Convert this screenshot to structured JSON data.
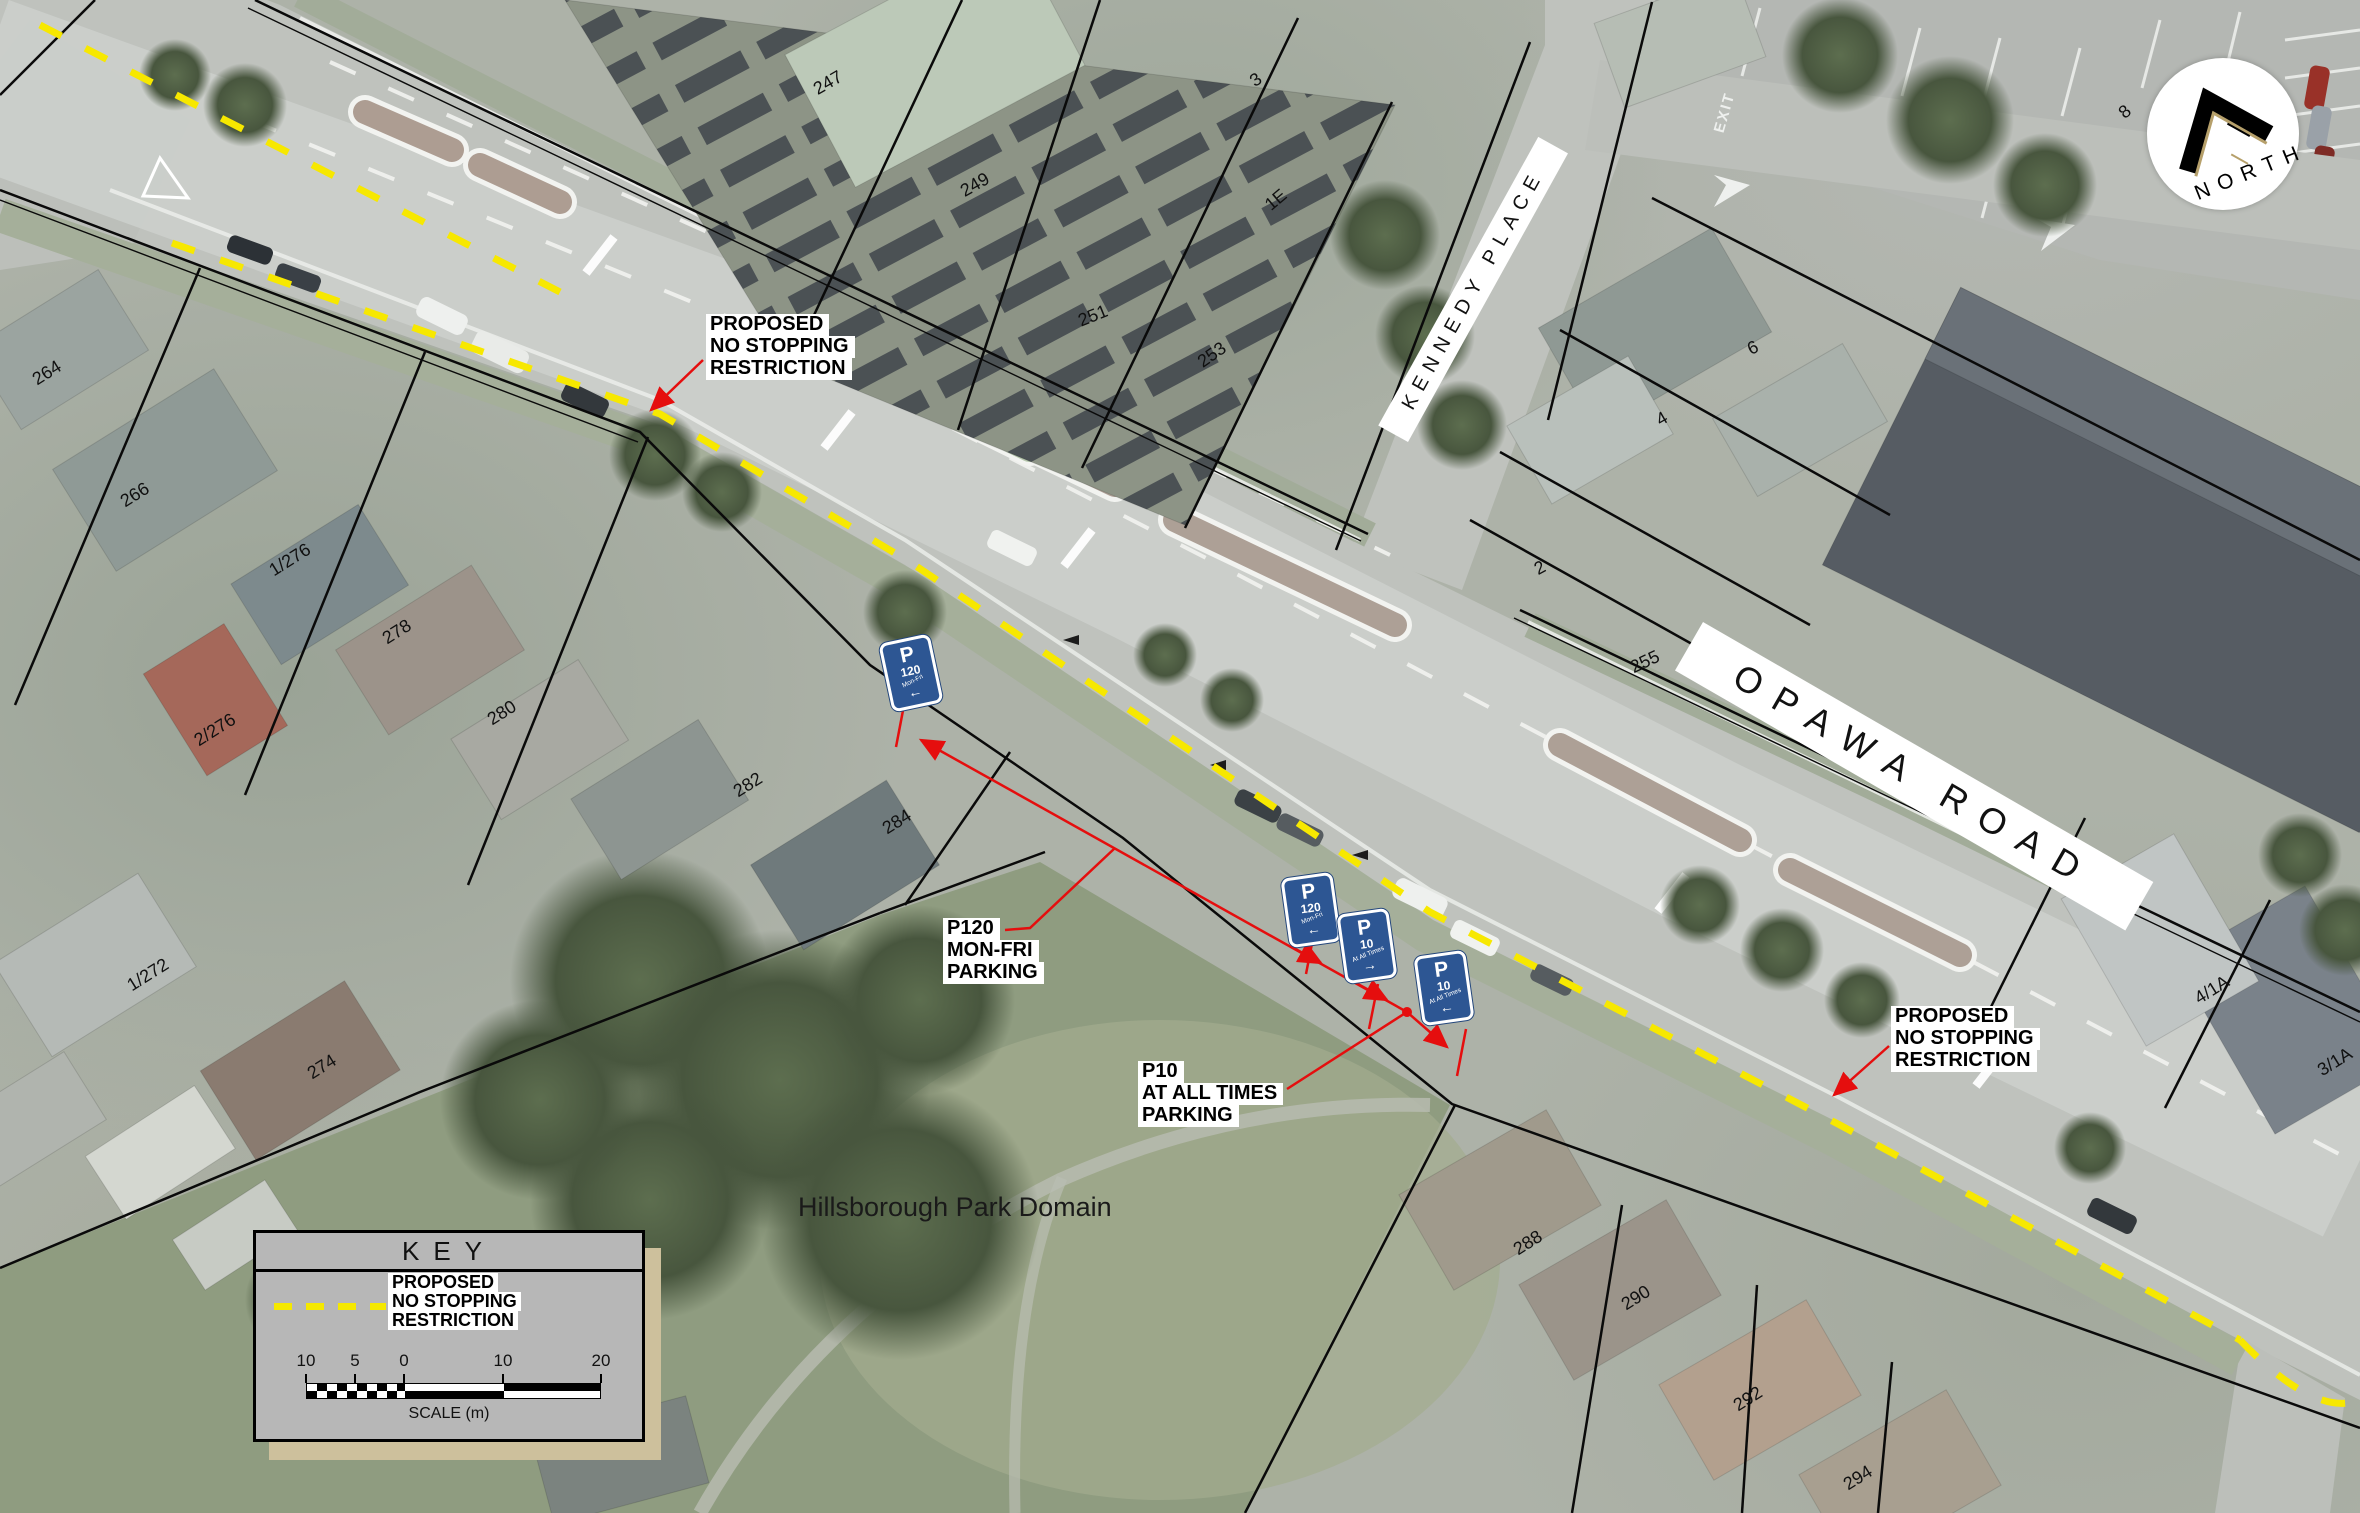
{
  "colors": {
    "no_stopping_yellow": "#f7e800",
    "leader_red": "#e50e0e",
    "sign_blue": "#2d5693",
    "cadastral_black": "#0a0a0a"
  },
  "north_arrow": {
    "label": "NORTH"
  },
  "streets": {
    "opawa_road": "OPAWA ROAD",
    "kennedy_place": "KENNEDY PLACE"
  },
  "park": {
    "name": "Hillsborough Park Domain"
  },
  "road_markings": {
    "exit": "EXIT"
  },
  "callouts": {
    "no_stopping_west": {
      "lines": [
        "PROPOSED",
        "NO STOPPING",
        "RESTRICTION"
      ]
    },
    "no_stopping_east": {
      "lines": [
        "PROPOSED",
        "NO STOPPING",
        "RESTRICTION"
      ]
    },
    "p120": {
      "lines": [
        "P120",
        "MON-FRI",
        "PARKING"
      ]
    },
    "p10": {
      "lines": [
        "P10",
        "AT ALL TIMES",
        "PARKING"
      ]
    }
  },
  "signs": [
    {
      "symbol": "P",
      "value": "120",
      "when": "Mon-Fri",
      "arrow": "←"
    },
    {
      "symbol": "P",
      "value": "120",
      "when": "Mon-Fri",
      "arrow": "←"
    },
    {
      "symbol": "P",
      "value": "10",
      "when": "At All Times",
      "arrow": "→"
    },
    {
      "symbol": "P",
      "value": "10",
      "when": "At All Times",
      "arrow": "←"
    }
  ],
  "key": {
    "title": "KEY",
    "entry_label": {
      "lines": [
        "PROPOSED",
        "NO STOPPING",
        "RESTRICTION"
      ]
    },
    "scale": {
      "ticks": [
        "10",
        "5",
        "0",
        "10",
        "20"
      ],
      "caption": "SCALE (m)"
    }
  },
  "parcels": [
    {
      "text": "247"
    },
    {
      "text": "249"
    },
    {
      "text": "251"
    },
    {
      "text": "253"
    },
    {
      "text": "3"
    },
    {
      "text": "1E"
    },
    {
      "text": "8"
    },
    {
      "text": "6"
    },
    {
      "text": "4"
    },
    {
      "text": "2"
    },
    {
      "text": "255"
    },
    {
      "text": "264"
    },
    {
      "text": "266"
    },
    {
      "text": "1/276"
    },
    {
      "text": "278"
    },
    {
      "text": "280"
    },
    {
      "text": "2/276"
    },
    {
      "text": "282"
    },
    {
      "text": "284"
    },
    {
      "text": "1/272"
    },
    {
      "text": "274"
    },
    {
      "text": "4/1A"
    },
    {
      "text": "3/1A"
    },
    {
      "text": "288"
    },
    {
      "text": "290"
    },
    {
      "text": "292"
    },
    {
      "text": "294"
    }
  ]
}
